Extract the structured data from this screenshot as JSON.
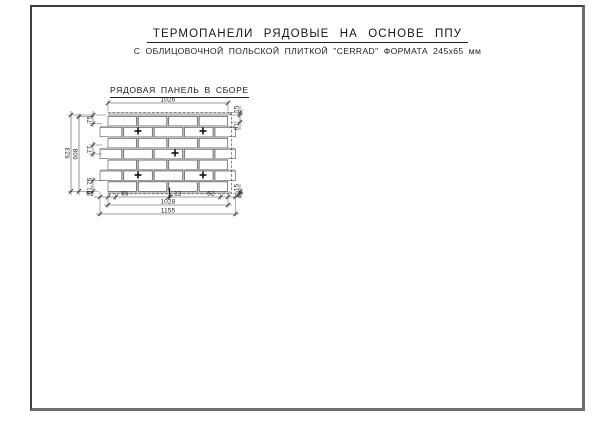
{
  "header": {
    "title": "ТЕРМОПАНЕЛИ РЯДОВЫЕ НА ОСНОВЕ ППУ",
    "subtitle": "С ОБЛИЦОВОЧНОЙ ПОЛЬСКОЙ ПЛИТКОЙ \"CERRAD\" ФОРМАТА 245x65 мм"
  },
  "drawing": {
    "label": "РЯДОВАЯ ПАНЕЛЬ В СБОРЕ",
    "dims": {
      "top_width": "1026",
      "top_lip": "15",
      "right_upper": "61",
      "right_lower": "15",
      "right_end": "65",
      "height_overall": "623",
      "height_inner": "608",
      "left_top": "75",
      "left_course": "77",
      "left_bottom": "91,75",
      "bottom_left_offset": "62",
      "bottom_left_step": "65",
      "joint": "12",
      "bottom_right_offset": "62",
      "bottom_width_inner": "1028",
      "bottom_width_overall": "1155"
    }
  }
}
